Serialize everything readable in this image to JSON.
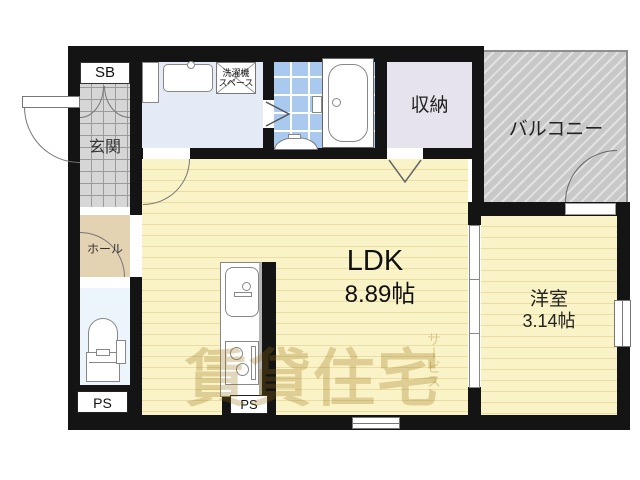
{
  "plan": {
    "sb_label": "SB",
    "genkan_label": "玄関",
    "hall_label": "ホール",
    "ps_left_label": "PS",
    "ps_center_label": "PS",
    "washer_line1": "洗濯機",
    "washer_line2": "スペース",
    "storage_label": "収納",
    "balcony_label": "バルコニー",
    "ldk_label": "LDK",
    "ldk_size": "8.89帖",
    "western_label": "洋室",
    "western_size": "3.14帖"
  },
  "watermark": {
    "main": "賃貸住宅",
    "sub": "サービス"
  },
  "colors": {
    "wall": "#141414",
    "ldk_floor": "#faf3c8",
    "ldk_stripe": "#e9dda0",
    "genkan_tile": "#d6d6d6",
    "hall_floor": "#e3d3b2",
    "toilet_floor": "#ecf4fc",
    "washroom_floor": "#e4ebf6",
    "bathroom_tile": "#a9c9ef",
    "storage_floor": "#e7e3ec",
    "balcony_base": "#c8c8c8",
    "watermark": "#96700c"
  }
}
